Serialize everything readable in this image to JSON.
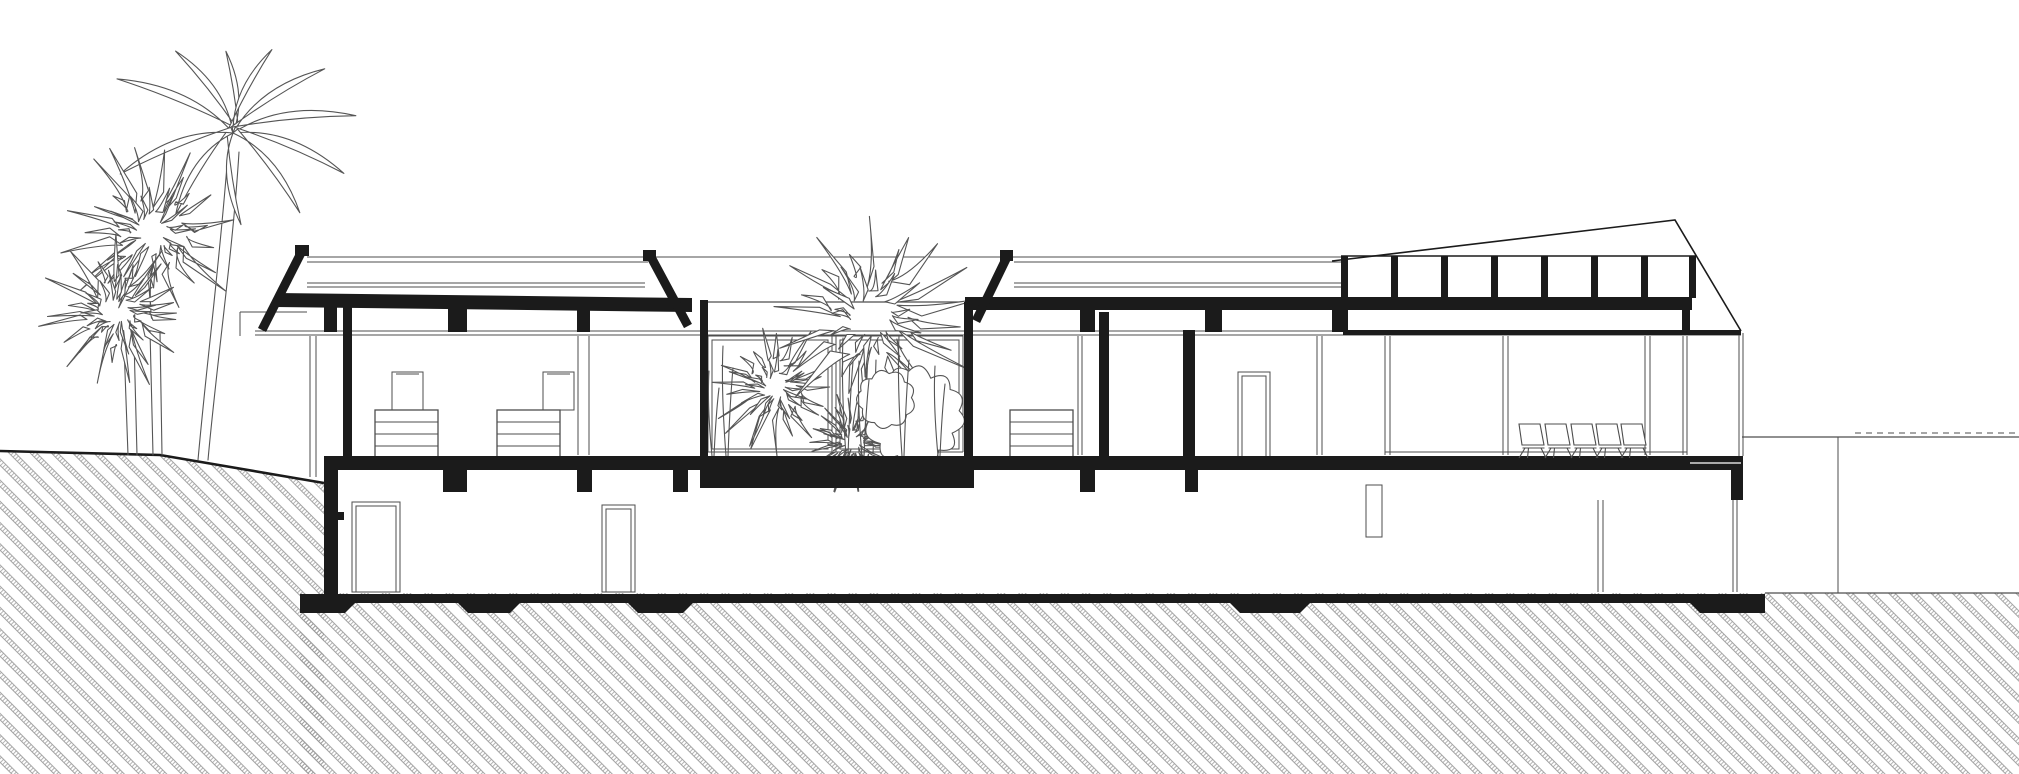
{
  "meta": {
    "title": "Architectural cross-section drawing",
    "drawing_type": "building section / elevation, black and white line art",
    "description": "Two-level house cut in section: upper living floor with two low-pitched roofs, a glazed interior planted courtyard, a taller hall with clerestory windows under a mono-pitch roof, and a basement level on a sloping hatched terrain with palm trees at the left."
  },
  "canvas": {
    "width": 2019,
    "height": 774
  },
  "colors": {
    "background": "#ffffff",
    "ink": "#1b1b1b",
    "line": "#4d4d4d",
    "hatch": "#9a9a9a",
    "plant": "#555555"
  },
  "section": {
    "levels": [
      "upper floor",
      "basement"
    ],
    "floor_slab": {
      "x": 324,
      "y": 456,
      "w": 1419,
      "h": 14
    },
    "courtyard_block": {
      "x": 700,
      "y": 456,
      "w": 274,
      "h": 32
    },
    "base_slab": {
      "x": 300,
      "y": 594,
      "w": 1465,
      "h": 9
    },
    "footings": [
      {
        "x1": 300,
        "x2": 345,
        "cl": 0,
        "cr": 1
      },
      {
        "x1": 468,
        "x2": 510,
        "cl": 1,
        "cr": 1
      },
      {
        "x1": 638,
        "x2": 683,
        "cl": 1,
        "cr": 1
      },
      {
        "x1": 1240,
        "x2": 1300,
        "cl": 1,
        "cr": 1
      },
      {
        "x1": 1700,
        "x2": 1765,
        "cl": 1,
        "cr": 0
      }
    ],
    "columns": [
      {
        "x": 343,
        "y": 299,
        "w": 9,
        "h": 158
      },
      {
        "x": 700,
        "y": 300,
        "w": 8,
        "h": 158
      },
      {
        "x": 964,
        "y": 302,
        "w": 9,
        "h": 156
      },
      {
        "x": 1099,
        "y": 312,
        "w": 10,
        "h": 145
      },
      {
        "x": 1183,
        "y": 330,
        "w": 12,
        "h": 127
      }
    ],
    "roof_stubs": [
      [
        324,
        337
      ],
      [
        448,
        467
      ],
      [
        577,
        590
      ],
      [
        1080,
        1095
      ],
      [
        1205,
        1222
      ],
      [
        1332,
        1348
      ]
    ],
    "basement_stubs": [
      [
        443,
        467
      ],
      [
        577,
        592
      ],
      [
        673,
        688
      ],
      [
        1080,
        1095
      ],
      [
        1185,
        1198
      ]
    ],
    "basement_wall": {
      "x": 324,
      "y": 470,
      "w": 14,
      "h": 124
    },
    "glazing_pairs": [
      [
        578,
        589
      ],
      [
        1078,
        1082
      ],
      [
        1317,
        1322
      ],
      [
        1385,
        1390
      ],
      [
        1503,
        1508
      ],
      [
        1645,
        1650
      ],
      [
        1683,
        1687
      ]
    ],
    "doors": [
      {
        "x": 352,
        "y": 502,
        "w": 48,
        "h": 90
      },
      {
        "x": 602,
        "y": 505,
        "w": 33,
        "h": 87
      },
      {
        "x": 1238,
        "y": 372,
        "w": 32,
        "h": 86
      }
    ],
    "dressers": [
      {
        "x": 375,
        "y": 410,
        "mirror": true,
        "mirror_dx": 17
      },
      {
        "x": 497,
        "y": 410,
        "mirror": true,
        "mirror_dx": 46
      },
      {
        "x": 1010,
        "y": 410,
        "mirror": false,
        "mirror_dx": 0
      }
    ],
    "chairs": {
      "count": 5,
      "xs": [
        1516,
        1542,
        1568,
        1593,
        1618
      ],
      "y": 424
    },
    "clerestory": {
      "pane_count": 7,
      "mullion_xs": [
        1341,
        1391,
        1441,
        1491,
        1541,
        1591,
        1641,
        1689
      ],
      "top_y": 256,
      "sill_y": 297,
      "mullion_w": 7
    },
    "terrain": {
      "left_surface": [
        [
          0,
          451
        ],
        [
          160,
          455
        ],
        [
          324,
          483
        ]
      ],
      "right_ground_y": 437,
      "right_drop_x": 1838,
      "right_hatch_top_y": 593
    }
  },
  "vegetation": {
    "tall_palm": {
      "crown_center": [
        233,
        133
      ],
      "fronds": [
        {
          "a": -155,
          "l": 128,
          "b": 26
        },
        {
          "a": -125,
          "l": 100,
          "b": 22
        },
        {
          "a": -95,
          "l": 82,
          "b": 18
        },
        {
          "a": -65,
          "l": 92,
          "b": -20
        },
        {
          "a": -35,
          "l": 112,
          "b": -24
        },
        {
          "a": -8,
          "l": 124,
          "b": -26
        },
        {
          "a": 20,
          "l": 118,
          "b": -26
        },
        {
          "a": 50,
          "l": 104,
          "b": -22
        },
        {
          "a": 85,
          "l": 92,
          "b": 20
        },
        {
          "a": 125,
          "l": 100,
          "b": 24
        },
        {
          "a": 160,
          "l": 120,
          "b": 26
        }
      ]
    },
    "bursts": [
      {
        "cx": 152,
        "cy": 233,
        "r": 92,
        "n": 26,
        "s": 7
      },
      {
        "cx": 117,
        "cy": 312,
        "r": 80,
        "n": 26,
        "s": 13
      },
      {
        "cx": 775,
        "cy": 388,
        "r": 70,
        "n": 24,
        "s": 21
      },
      {
        "cx": 852,
        "cy": 442,
        "r": 52,
        "n": 28,
        "s": 31
      },
      {
        "cx": 870,
        "cy": 318,
        "r": 112,
        "n": 24,
        "s": 41
      }
    ],
    "bush_blobs": [
      {
        "cx": 914,
        "cy": 416,
        "r": 46,
        "l": 12,
        "s": 51
      },
      {
        "cx": 886,
        "cy": 399,
        "r": 27,
        "l": 9,
        "s": 61
      }
    ],
    "grass": [
      {
        "x": 712,
        "h": 85
      },
      {
        "x": 726,
        "h": 110
      },
      {
        "x": 846,
        "h": 118
      },
      {
        "x": 862,
        "h": 95
      },
      {
        "x": 902,
        "h": 120
      },
      {
        "x": 938,
        "h": 90
      }
    ]
  }
}
